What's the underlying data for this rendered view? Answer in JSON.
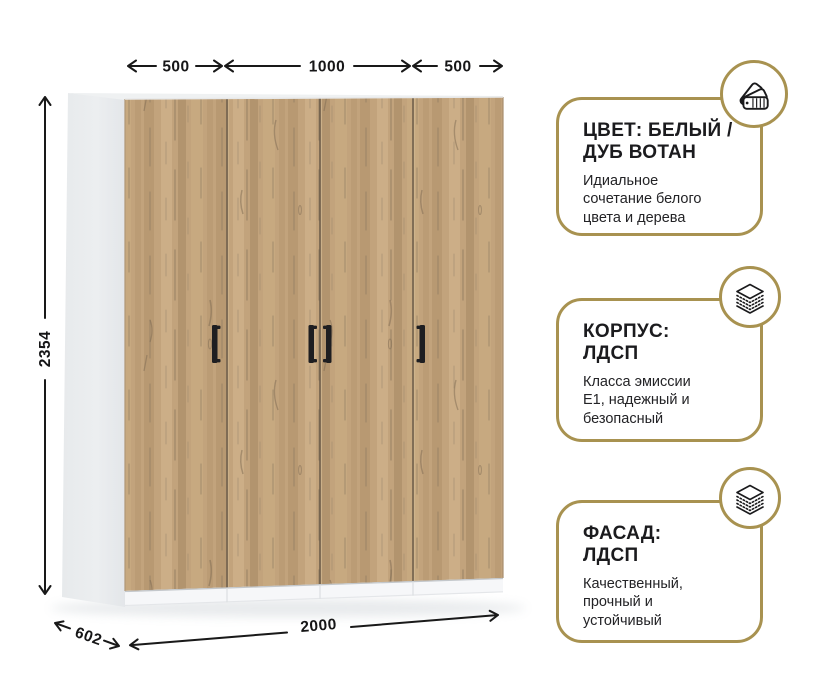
{
  "product": {
    "name": "wardrobe",
    "dimensions": {
      "top_left_mm": "500",
      "top_middle_mm": "1000",
      "top_right_mm": "500",
      "height_mm": "2354",
      "depth_mm": "602",
      "width_mm": "2000"
    },
    "colors": {
      "wood_base": "#C2A37C",
      "wood_streak": "#8E7B60",
      "side_panel": "#ECEEF0",
      "handle": "#1E1E21"
    }
  },
  "features": {
    "cards": [
      {
        "icon": "color-swatch-fan",
        "title": "ЦВЕТ: БЕЛЫЙ /\nДУБ ВОТАН",
        "body": "Идиальное\nсочетание белого\nцвета и дерева"
      },
      {
        "icon": "laminated-layers",
        "title": "КОРПУС:\nЛДСП",
        "body": "Класса эмиссии\nЕ1, надежный и\nбезопасный"
      },
      {
        "icon": "laminated-layers",
        "title": "ФАСАД:\nЛДСП",
        "body": "Качественный,\nпрочный и\nустойчивый"
      }
    ]
  },
  "theme": {
    "accent_gold": "#A89250",
    "text_dark": "#1B1B1E",
    "background": "#FFFFFF"
  }
}
